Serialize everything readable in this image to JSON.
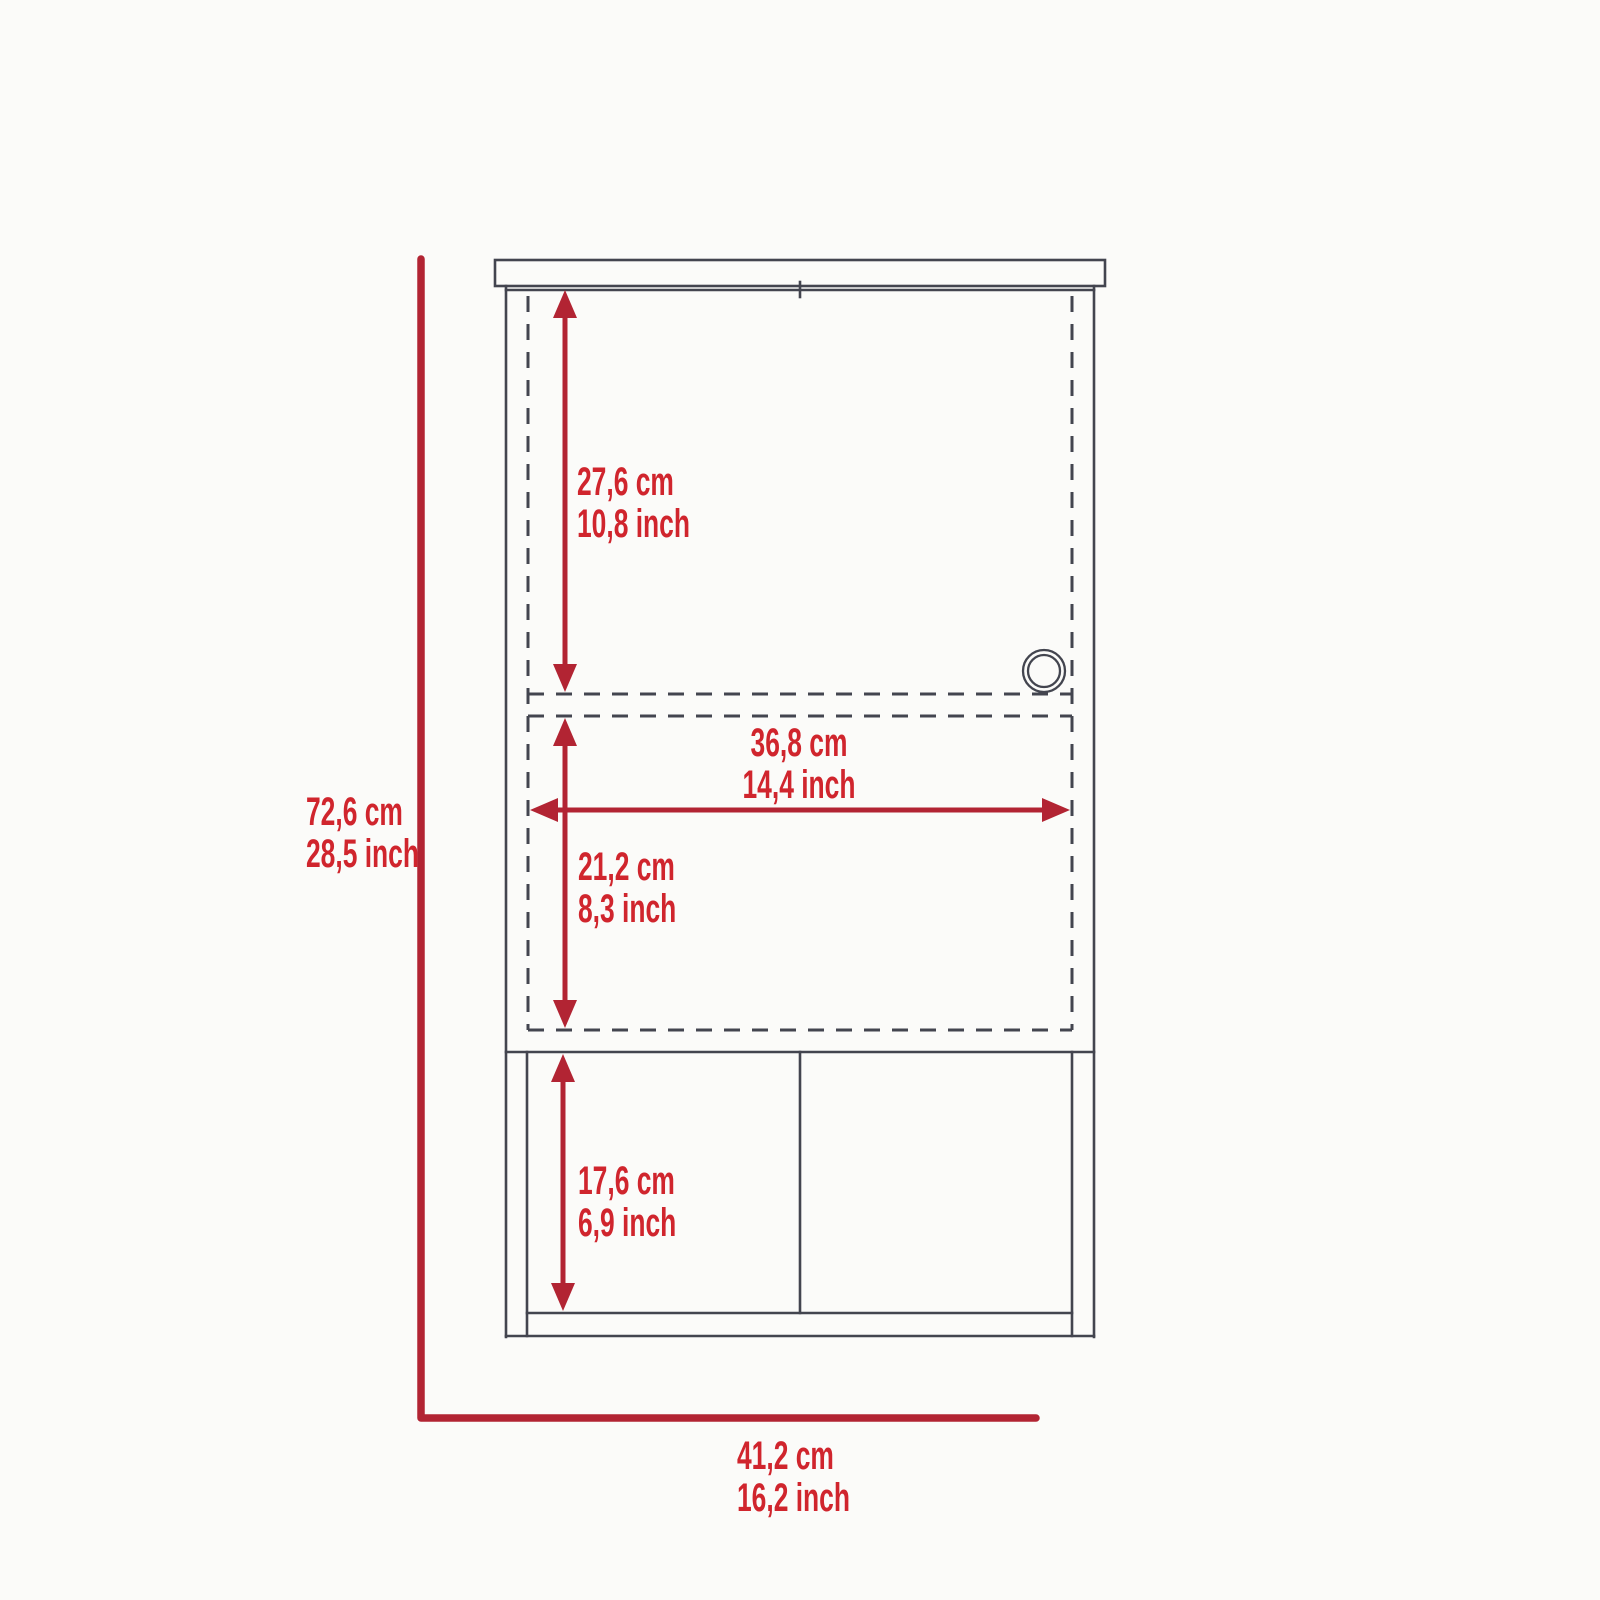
{
  "diagram": {
    "type": "furniture-dimension-drawing",
    "subject": "wall cabinet front elevation with dimension callouts",
    "dimensions": {
      "upper_door_height": {
        "cm": "27,6 cm",
        "inch": "10,8 inch"
      },
      "door_width": {
        "cm": "36,8 cm",
        "inch": "14,4 inch"
      },
      "middle_section_height": {
        "cm": "21,2 cm",
        "inch": "8,3 inch"
      },
      "lower_section_height": {
        "cm": "17,6 cm",
        "inch": "6,9 inch"
      },
      "overall_height": {
        "cm": "72,6 cm",
        "inch": "28,5 inch"
      },
      "overall_width": {
        "cm": "41,2 cm",
        "inch": "16,2 inch"
      }
    }
  },
  "colors": {
    "dim-red": "#b22433",
    "label-red": "#d0252d",
    "line-gray": "#43454f",
    "bg": "#fbfbf9"
  }
}
